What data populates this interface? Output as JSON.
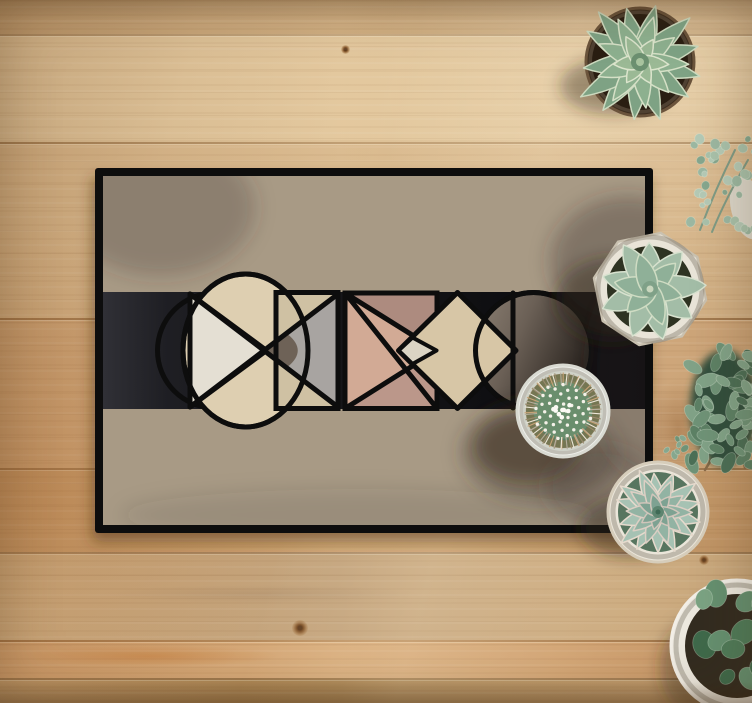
{
  "scene": {
    "description": "Top-down photo of a geometric-pattern doormat on a wooden plank floor, surrounded by potted succulents and a cactus",
    "objects": [
      "doormat with geometric pattern",
      "echeveria succulent in dark pot",
      "eucalyptus sprigs",
      "pachyphytum succulent in white faceted pot",
      "bean succulent",
      "blue echeveria in white bowl",
      "jade plant in white pot",
      "mammillaria cactus in white pot",
      "oak plank floor"
    ]
  },
  "palette": {
    "wood_base": "#d2b084",
    "mat_field": "#a89a85",
    "mat_border": "#0e0e0e",
    "band_black": "#141417",
    "cream": "#decfb1",
    "light_cream": "#e4dfd3",
    "tan": "#cfc1a3",
    "grey": "#a8a4a1",
    "dark_taupe": "#6e6257",
    "pink": "#d2aa95",
    "mauve_dark": "#ad8b7f",
    "mauve_mid": "#bb978a",
    "beige_diamond": "#d7c6a6",
    "circle_dark": "#6b6056",
    "succulent_green": "#8db08f"
  },
  "wood": {
    "planks": [
      {
        "y": 0,
        "h": 34,
        "c1": "#c2a075",
        "c2": "#d2b185"
      },
      {
        "y": 34,
        "h": 108,
        "c1": "#dabe94",
        "c2": "#e5caa0"
      },
      {
        "y": 142,
        "h": 176,
        "c1": "#d2b084",
        "c2": "#dcbd92"
      },
      {
        "y": 318,
        "h": 150,
        "c1": "#cca376",
        "c2": "#d6b184"
      },
      {
        "y": 468,
        "h": 84,
        "c1": "#c49868",
        "c2": "#cfa675"
      },
      {
        "y": 552,
        "h": 88,
        "c1": "#cead81",
        "c2": "#c2a27b"
      },
      {
        "y": 640,
        "h": 38,
        "c1": "#cf9f6e",
        "c2": "#d9ad7c"
      },
      {
        "y": 678,
        "h": 25,
        "c1": "#bf996a",
        "c2": "#a8814e"
      }
    ],
    "seams": [
      34,
      142,
      318,
      468,
      552,
      640,
      678
    ],
    "knots": [
      {
        "x": 300,
        "y": 628,
        "s": 16
      },
      {
        "x": 345,
        "y": 49,
        "s": 9
      },
      {
        "x": 704,
        "y": 560,
        "s": 10
      }
    ],
    "streaks": [
      {
        "x": 20,
        "y": 645,
        "w": 260,
        "h": 22,
        "c": "rgba(198,125,58,0.5)"
      },
      {
        "x": 648,
        "y": 380,
        "w": 60,
        "h": 95,
        "c": "rgba(130,78,34,0.38)"
      },
      {
        "x": 100,
        "y": 585,
        "w": 320,
        "h": 18,
        "c": "rgba(150,120,90,0.25)"
      }
    ]
  },
  "mat": {
    "x": 95,
    "y": 168,
    "w": 558,
    "h": 365,
    "border": 8,
    "pattern": {
      "shapes": [
        {
          "tag": "rect",
          "attr": {
            "x": 95,
            "y": 168,
            "width": 558,
            "height": 365,
            "rx": 3,
            "fill": "#0e0e0e",
            "filter": "url(#matDrop)"
          }
        },
        {
          "tag": "rect",
          "attr": {
            "x": 103,
            "y": 176,
            "width": 542,
            "height": 349,
            "fill": "#a89a85"
          }
        },
        {
          "tag": "rect",
          "attr": {
            "x": 103,
            "y": 292,
            "width": 542,
            "height": 117,
            "fill": "url(#bandG)"
          }
        },
        {
          "tag": "circle",
          "attr": {
            "cx": 215,
            "cy": 350.5,
            "r": 57.5,
            "fill": "none",
            "stroke": "#0d0d0d",
            "stroke-width": 5
          }
        },
        {
          "tag": "ellipse",
          "attr": {
            "cx": 245.5,
            "cy": 350.5,
            "rx": 62.5,
            "ry": 76.5,
            "fill": "#decfb1",
            "stroke": "#0d0d0d",
            "stroke-width": 5
          }
        },
        {
          "tag": "path",
          "attr": {
            "d": "M190,294 L190,407 L266.5,350.5 Z",
            "fill": "#e4dfd3",
            "stroke": "#0d0d0d",
            "stroke-width": 5,
            "stroke-linejoin": "round"
          }
        },
        {
          "tag": "rect",
          "attr": {
            "x": 276,
            "y": 292.5,
            "width": 62,
            "height": 116,
            "fill": "#cfc1a3",
            "stroke": "#0d0d0d",
            "stroke-width": 5
          }
        },
        {
          "tag": "path",
          "attr": {
            "d": "M266.5,350.5 L338,294 L338,407 Z",
            "fill": "#a8a4a1"
          }
        },
        {
          "tag": "path",
          "attr": {
            "d": "M266.5,350.5 L288,334.5 Q307.5,350.5 288,366.5 Z",
            "fill": "#6e6257"
          }
        },
        {
          "tag": "path",
          "attr": {
            "d": "M190,294 L338,407 M190,407 L338,294",
            "fill": "none",
            "stroke": "#0d0d0d",
            "stroke-width": 5,
            "stroke-linecap": "round"
          }
        },
        {
          "tag": "ellipse",
          "attr": {
            "cx": 245.5,
            "cy": 350.5,
            "rx": 62.5,
            "ry": 76.5,
            "fill": "none",
            "stroke": "#0d0d0d",
            "stroke-width": 5
          }
        },
        {
          "tag": "rect",
          "attr": {
            "x": 276,
            "y": 292.5,
            "width": 62,
            "height": 116,
            "fill": "none",
            "stroke": "#0d0d0d",
            "stroke-width": 5
          }
        },
        {
          "tag": "rect",
          "attr": {
            "x": 345,
            "y": 293,
            "width": 92,
            "height": 115.5,
            "fill": "#d2aa95",
            "stroke": "#0d0d0d",
            "stroke-width": 5
          }
        },
        {
          "tag": "path",
          "attr": {
            "d": "M345,293 L437,293 L437,350.5 Z",
            "fill": "#ad8b7f"
          }
        },
        {
          "tag": "path",
          "attr": {
            "d": "M345,408.5 L437,408.5 L437,350.5 Z",
            "fill": "#bb978a"
          }
        },
        {
          "tag": "path",
          "attr": {
            "d": "M345,293 L437,350.5 L345,408.5 M345,293 L437,408.5",
            "fill": "none",
            "stroke": "#0d0d0d",
            "stroke-width": 5,
            "stroke-linecap": "round"
          }
        },
        {
          "tag": "rect",
          "attr": {
            "x": 345,
            "y": 293,
            "width": 92,
            "height": 115.5,
            "fill": "none",
            "stroke": "#0d0d0d",
            "stroke-width": 5
          }
        },
        {
          "tag": "circle",
          "attr": {
            "cx": 533.5,
            "cy": 350.5,
            "r": 58,
            "fill": "url(#circG)",
            "stroke": "#0d0d0d",
            "stroke-width": 5
          }
        },
        {
          "tag": "path",
          "attr": {
            "d": "M457.5,292.5 L516,350.5 L457.5,408.5 L398.5,350.5 Z",
            "fill": "#d7c6a6",
            "stroke": "#0d0d0d",
            "stroke-width": 5,
            "stroke-linejoin": "round"
          }
        },
        {
          "tag": "path",
          "attr": {
            "d": "M398.5,350.5 L412.5,337.5 L436.5,350.5 L412.5,364 Z",
            "fill": "#dbd4c4",
            "stroke": "#0d0d0d",
            "stroke-width": 4,
            "stroke-linejoin": "round"
          }
        },
        {
          "tag": "line",
          "attr": {
            "x1": 513,
            "y1": 293,
            "x2": 513,
            "y2": 408,
            "stroke": "#0d0d0d",
            "stroke-width": 5,
            "stroke-linecap": "round"
          }
        },
        {
          "tag": "circle",
          "attr": {
            "cx": 533.5,
            "cy": 350.5,
            "r": 58,
            "fill": "none",
            "stroke": "#0d0d0d",
            "stroke-width": 5
          }
        }
      ]
    },
    "shadows": [
      {
        "cx": 160,
        "cy": 208,
        "rx": 95,
        "ry": 68,
        "o": 0.26
      },
      {
        "cx": 628,
        "cy": 262,
        "rx": 78,
        "ry": 66,
        "o": 0.34
      },
      {
        "cx": 540,
        "cy": 452,
        "rx": 78,
        "ry": 50,
        "o": 0.4
      },
      {
        "cx": 600,
        "cy": 486,
        "rx": 55,
        "ry": 40,
        "o": 0.3
      },
      {
        "cx": 645,
        "cy": 370,
        "rx": 55,
        "ry": 105,
        "o": 0.28
      },
      {
        "cx": 360,
        "cy": 515,
        "rx": 240,
        "ry": 26,
        "o": 0.12
      }
    ]
  },
  "plants": [
    {
      "name": "succulent-echeveria-top",
      "type": "rosette",
      "cx": 640,
      "cy": 62,
      "tip": "point",
      "shadow": {
        "cx": 614,
        "cy": 86,
        "rx": 54,
        "ry": 28,
        "o": 0.4
      },
      "pot": {
        "shape": "circle",
        "r": 54,
        "fill": "#3f2f20",
        "stroke": "#6b543c",
        "soilR": 48,
        "soil": "#2a1e12"
      },
      "rings": [
        {
          "n": 13,
          "len": 64,
          "w": 14,
          "color": "#7ea284",
          "edge": "#ccdabf",
          "start": -8
        },
        {
          "n": 9,
          "len": 44,
          "w": 12.5,
          "color": "#8db08f",
          "edge": "#d5e0c6",
          "start": 12
        },
        {
          "n": 6,
          "len": 26,
          "w": 10,
          "color": "#9bb995",
          "edge": "#dbe4cc",
          "start": 30
        }
      ],
      "core": [
        {
          "r": 9,
          "fill": "#6c9070"
        },
        {
          "r": 4,
          "fill": "#a9c49f"
        }
      ]
    },
    {
      "name": "eucalyptus-sprigs",
      "type": "cluster",
      "cx": 722,
      "cy": 186,
      "rx": 33,
      "ry": 47,
      "n": 36,
      "min": 2.5,
      "max": 5,
      "elong": 1.1,
      "seed": 3,
      "prePot": {
        "cx": 748,
        "cy": 208,
        "rx": 17,
        "ry": 32,
        "fill": "#dcd7ca"
      },
      "stems": [
        {
          "d": "M700,230 Q715,190 735,150",
          "s": "#7f9b85",
          "w": 2
        },
        {
          "d": "M712,232 Q725,200 748,160",
          "s": "#7f9b85",
          "w": 2
        }
      ],
      "colors": [
        "#9cb8a2",
        "#b5cab6",
        "#86a78e",
        "#a9c2ab"
      ]
    },
    {
      "name": "succulent-pachyphytum",
      "type": "rosette",
      "cx": 650,
      "cy": 289,
      "tip": "round",
      "shadow": {
        "cx": 612,
        "cy": 300,
        "rx": 56,
        "ry": 42,
        "o": 0.42
      },
      "pot": {
        "shape": "octagon",
        "r": 57,
        "rot": 11,
        "fill": "#e9e4d8",
        "stroke": "#c9c1b0",
        "soilR": 43,
        "soil": "#2e3322"
      },
      "rings": [
        {
          "n": 9,
          "len": 54,
          "w": 16,
          "color": "#a3bda7",
          "edge": "#d8e2cf",
          "start": 5
        },
        {
          "n": 6,
          "len": 34,
          "w": 13,
          "color": "#8fb098",
          "edge": "#cfdcc3",
          "start": 40
        }
      ],
      "core": [
        {
          "r": 8,
          "fill": "#7fa188"
        },
        {
          "r": 3.5,
          "fill": "#c8d6bd"
        }
      ]
    },
    {
      "name": "bean-succulent",
      "type": "cluster",
      "cx": 724,
      "cy": 408,
      "rx": 34,
      "ry": 58,
      "n": 58,
      "min": 3.5,
      "max": 6.5,
      "elong": 1.8,
      "seed": 11,
      "under": "#31503c",
      "stems": [
        {
          "d": "M705,470 Q720,445 730,430",
          "s": "#8a6b49",
          "w": 2.5
        },
        {
          "d": "M745,468 Q740,445 735,428",
          "s": "#8a6b49",
          "w": 2.5
        }
      ],
      "colors": [
        "#5d8165",
        "#6f9377",
        "#81a287",
        "#4c6f56"
      ]
    },
    {
      "name": "small-sprig",
      "type": "cluster",
      "cx": 676,
      "cy": 446,
      "rx": 10,
      "ry": 12,
      "n": 7,
      "min": 2,
      "max": 3.5,
      "elong": 1.4,
      "seed": 21,
      "colors": [
        "#6f9377",
        "#86a78e"
      ]
    },
    {
      "name": "succulent-echeveria-bowl",
      "type": "rosette",
      "cx": 658,
      "cy": 512,
      "tip": "point",
      "shadow": {
        "cx": 632,
        "cy": 528,
        "rx": 52,
        "ry": 30,
        "o": 0.42
      },
      "pot": {
        "shape": "circle",
        "r": 50,
        "fill": "#ebe6da",
        "stroke": "#d6cdbb",
        "soilR": 40,
        "soil": "#57755f"
      },
      "rings": [
        {
          "n": 14,
          "len": 45,
          "w": 11,
          "color": "#a6c2b3",
          "edge": "#e6dacd",
          "start": 0
        },
        {
          "n": 10,
          "len": 31,
          "w": 9.5,
          "color": "#92b3a3",
          "edge": "#dccfc4",
          "start": 18
        },
        {
          "n": 7,
          "len": 19,
          "w": 7.5,
          "color": "#7ea292",
          "edge": "#d0c5ba",
          "start": 36
        }
      ],
      "core": [
        {
          "r": 6,
          "fill": "#5d8570"
        },
        {
          "r": 2.5,
          "fill": "#3f6a55"
        }
      ]
    },
    {
      "name": "jade-plant",
      "type": "cluster",
      "cx": 744,
      "cy": 634,
      "rx": 50,
      "ry": 56,
      "n": 24,
      "min": 6,
      "max": 12,
      "elong": 1.25,
      "seed": 7,
      "pot": {
        "shape": "circle",
        "cx": 737,
        "cy": 646,
        "r": 66,
        "fill": "#ece8de",
        "stroke": "#f2eee6",
        "soilR": 52,
        "soil": "#332c20"
      },
      "shadow": {
        "cx": 698,
        "cy": 668,
        "rx": 38,
        "ry": 48,
        "o": 0.38
      },
      "colors": [
        "#4f7b59",
        "#659070",
        "#7ba383",
        "#3f6a4b"
      ]
    },
    {
      "name": "cactus",
      "type": "cactus",
      "cx": 563,
      "cy": 411,
      "shadow": {
        "cx": 528,
        "cy": 446,
        "rx": 52,
        "ry": 34,
        "o": 0.45
      },
      "pot": {
        "shape": "circle",
        "r": 46,
        "fill": "#edeee9",
        "stroke": "#d9dad2",
        "soilR": 40,
        "soil": "#cfd2c8"
      },
      "body": {
        "r": 37,
        "fill": "#5b7d62",
        "inner": "#6d9070"
      },
      "dots": {
        "n": 44,
        "R": 29,
        "r": 1.7,
        "fill": "#f4f1e8"
      },
      "fringe": {
        "n": 64,
        "r0": 26,
        "r1": 38.5,
        "colors": [
          "#c7a377",
          "#ece6d8",
          "#9a8a6d",
          "#b5ae9d"
        ]
      },
      "fuzz": {
        "n": 9,
        "R": 10,
        "r": 2.3,
        "fill": "#fbfaf4"
      }
    }
  ]
}
